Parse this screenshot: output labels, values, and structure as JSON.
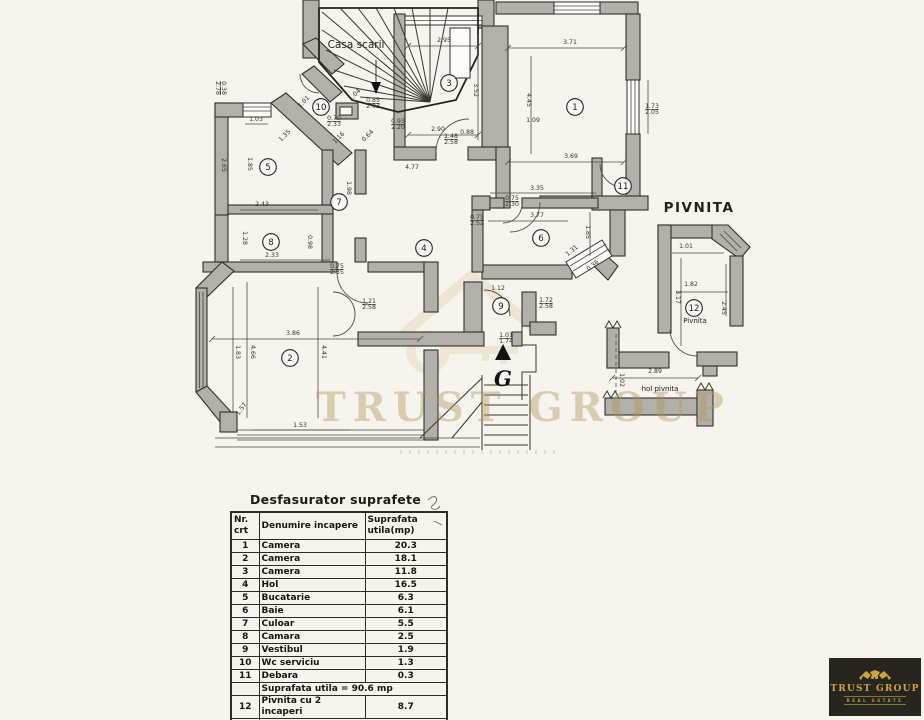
{
  "plan": {
    "labels": {
      "casa_scarii": "Casa scarii",
      "pivnita_title": "PIVNITA",
      "pivnita_room": "Pivnita",
      "hol_pivnita": "hol pivnita",
      "compass": "G"
    },
    "rooms": [
      {
        "num": "1",
        "x": 575,
        "y": 107
      },
      {
        "num": "2",
        "x": 290,
        "y": 358
      },
      {
        "num": "3",
        "x": 449,
        "y": 83
      },
      {
        "num": "4",
        "x": 424,
        "y": 248
      },
      {
        "num": "5",
        "x": 268,
        "y": 167
      },
      {
        "num": "6",
        "x": 541,
        "y": 238
      },
      {
        "num": "7",
        "x": 339,
        "y": 202
      },
      {
        "num": "8",
        "x": 271,
        "y": 242
      },
      {
        "num": "9",
        "x": 501,
        "y": 306
      },
      {
        "num": "10",
        "x": 321,
        "y": 107
      },
      {
        "num": "11",
        "x": 623,
        "y": 186
      },
      {
        "num": "12",
        "x": 694,
        "y": 308
      }
    ],
    "dims": [
      {
        "t": "2.95",
        "x": 444,
        "y": 42
      },
      {
        "t": "3.71",
        "x": 570,
        "y": 44
      },
      {
        "t": "2.90",
        "x": 438,
        "y": 131
      },
      {
        "t": "3.69",
        "x": 571,
        "y": 158
      },
      {
        "t": "3.52",
        "x": 474,
        "y": 90,
        "r": 90
      },
      {
        "t": "4.45",
        "x": 527,
        "y": 100,
        "r": 90
      },
      {
        "t": "1.09",
        "x": 533,
        "y": 122
      },
      {
        "t": "0.88",
        "x": 467,
        "y": 134
      },
      {
        "t": "4.77",
        "x": 412,
        "y": 169
      },
      {
        "t": "3.35",
        "x": 537,
        "y": 190
      },
      {
        "t": "3.77",
        "x": 537,
        "y": 217
      },
      {
        "t": "1.85",
        "x": 586,
        "y": 232,
        "r": 90
      },
      {
        "t": "1.31",
        "x": 573,
        "y": 252,
        "r": -40
      },
      {
        "t": "0.36",
        "x": 594,
        "y": 267,
        "r": -40
      },
      {
        "t": "1.12",
        "x": 498,
        "y": 290
      },
      {
        "t": "3.86",
        "x": 293,
        "y": 335
      },
      {
        "t": "4.66",
        "x": 251,
        "y": 352,
        "r": 90
      },
      {
        "t": "1.83",
        "x": 236,
        "y": 352,
        "r": 90
      },
      {
        "t": "4.41",
        "x": 322,
        "y": 352,
        "r": 90
      },
      {
        "t": "1.53",
        "x": 300,
        "y": 427
      },
      {
        "t": "1.57",
        "x": 243,
        "y": 410,
        "r": -55
      },
      {
        "t": "1.03",
        "x": 256,
        "y": 121
      },
      {
        "t": "1.35",
        "x": 286,
        "y": 137,
        "r": -45
      },
      {
        "t": "1.01",
        "x": 305,
        "y": 103,
        "r": -45
      },
      {
        "t": "1.04",
        "x": 356,
        "y": 96,
        "r": -45
      },
      {
        "t": "1.16",
        "x": 340,
        "y": 139,
        "r": -45
      },
      {
        "t": "0.64",
        "x": 369,
        "y": 137,
        "r": -45
      },
      {
        "t": "2.65",
        "x": 222,
        "y": 165,
        "r": 90
      },
      {
        "t": "1.85",
        "x": 248,
        "y": 164,
        "r": 90
      },
      {
        "t": "2.43",
        "x": 262,
        "y": 206
      },
      {
        "t": "1.98",
        "x": 347,
        "y": 188,
        "r": 90
      },
      {
        "t": "2.33",
        "x": 272,
        "y": 257
      },
      {
        "t": "1.28",
        "x": 243,
        "y": 238,
        "r": 90
      },
      {
        "t": "0.98",
        "x": 308,
        "y": 242,
        "r": 90
      },
      {
        "t": "2.89",
        "x": 655,
        "y": 373
      },
      {
        "t": "1.82",
        "x": 691,
        "y": 286
      },
      {
        "t": "1.01",
        "x": 686,
        "y": 248
      },
      {
        "t": "3.17",
        "x": 676,
        "y": 297,
        "r": 90
      },
      {
        "t": "2.45",
        "x": 722,
        "y": 308,
        "r": 90
      },
      {
        "t": "1.02",
        "x": 620,
        "y": 380,
        "r": 90
      },
      {
        "lines": [
          "1.73",
          "2.05"
        ],
        "x": 652,
        "y": 108
      },
      {
        "lines": [
          "1.48",
          "2.58"
        ],
        "x": 451,
        "y": 138
      },
      {
        "lines": [
          "0.85",
          "2.03"
        ],
        "x": 373,
        "y": 102
      },
      {
        "lines": [
          "0.70",
          "2.33"
        ],
        "x": 334,
        "y": 120
      },
      {
        "lines": [
          "0.38",
          "2.78"
        ],
        "x": 222,
        "y": 88,
        "r": 90
      },
      {
        "lines": [
          "0.75",
          "2.30"
        ],
        "x": 512,
        "y": 200
      },
      {
        "lines": [
          "0.75",
          "2.52"
        ],
        "x": 477,
        "y": 219
      },
      {
        "lines": [
          "1.21",
          "2.58"
        ],
        "x": 369,
        "y": 303
      },
      {
        "lines": [
          "0.75",
          "2.35"
        ],
        "x": 337,
        "y": 268
      },
      {
        "lines": [
          "1.01",
          "1.74"
        ],
        "x": 506,
        "y": 337
      },
      {
        "lines": [
          "0.93",
          "2.20"
        ],
        "x": 398,
        "y": 123
      },
      {
        "lines": [
          "1.72",
          "2.58"
        ],
        "x": 546,
        "y": 302
      }
    ]
  },
  "watermark": {
    "text": "TRUST GROUP",
    "color": "#b29450"
  },
  "table": {
    "title": "Desfasurator suprafete",
    "headers": [
      "Nr. crt",
      "Denumire incapere",
      "Suprafata utila(mp)"
    ],
    "rows": [
      [
        "1",
        "Camera",
        "20.3"
      ],
      [
        "2",
        "Camera",
        "18.1"
      ],
      [
        "3",
        "Camera",
        "11.8"
      ],
      [
        "4",
        "Hol",
        "16.5"
      ],
      [
        "5",
        "Bucatarie",
        "6.3"
      ],
      [
        "6",
        "Baie",
        "6.1"
      ],
      [
        "7",
        "Culoar",
        "5.5"
      ],
      [
        "8",
        "Camara",
        "2.5"
      ],
      [
        "9",
        "Vestibul",
        "1.9"
      ],
      [
        "10",
        "Wc serviciu",
        "1.3"
      ],
      [
        "11",
        "Debara",
        "0.3"
      ]
    ],
    "subtotal": "Suprafata utila = 90.6 mp",
    "row12": [
      "12",
      "Pivnita cu 2 incaperi",
      "8.7"
    ],
    "total": "Suprafata totala = 99.3 mp"
  },
  "logo": {
    "brand": "TRUST GROUP",
    "tagline": "REAL ESTATE",
    "bg": "#262520",
    "gold": "#d2a33c"
  }
}
